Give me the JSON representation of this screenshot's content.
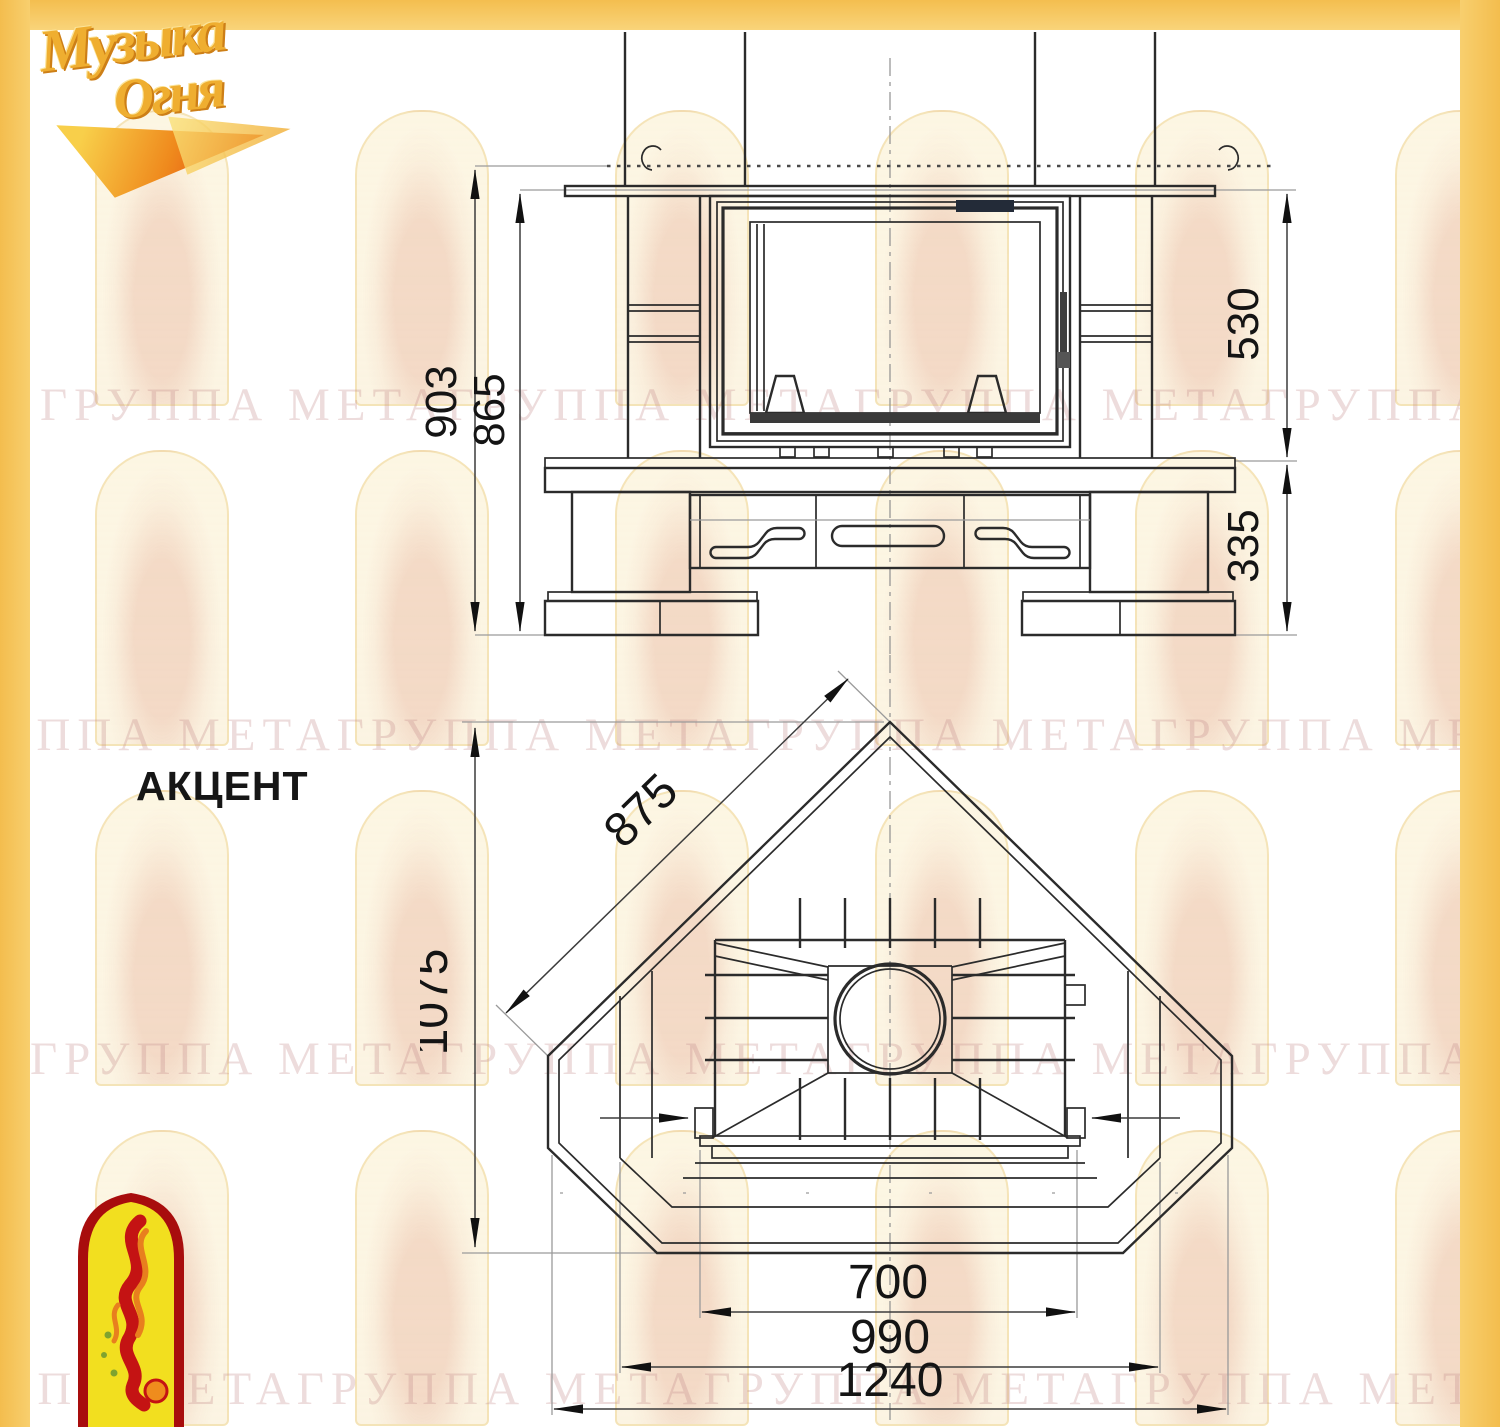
{
  "title": "АКЦЕНТ",
  "logo": {
    "line1": "Музыка",
    "line2": "Огня"
  },
  "watermark": {
    "row_text": "ГРУППА МЕТАГРУППА МЕТАГРУППА МЕТАГРУППА МЕТА"
  },
  "colors": {
    "frame_yellow": "#f4be4f",
    "logo_gold": "#efae30",
    "emblem_red": "#a80d0d",
    "emblem_yellow": "#f2df1f",
    "line_dark": "#2b2b2b"
  },
  "front_view": {
    "dim_total_height": "903",
    "dim_surround_height": "865",
    "dim_firebox_height": "530",
    "dim_base_height": "335"
  },
  "plan_view": {
    "dim_diagonal": "875",
    "dim_depth": "1075",
    "dim_opening_width": "700",
    "dim_body_width": "990",
    "dim_overall_width": "1240"
  }
}
